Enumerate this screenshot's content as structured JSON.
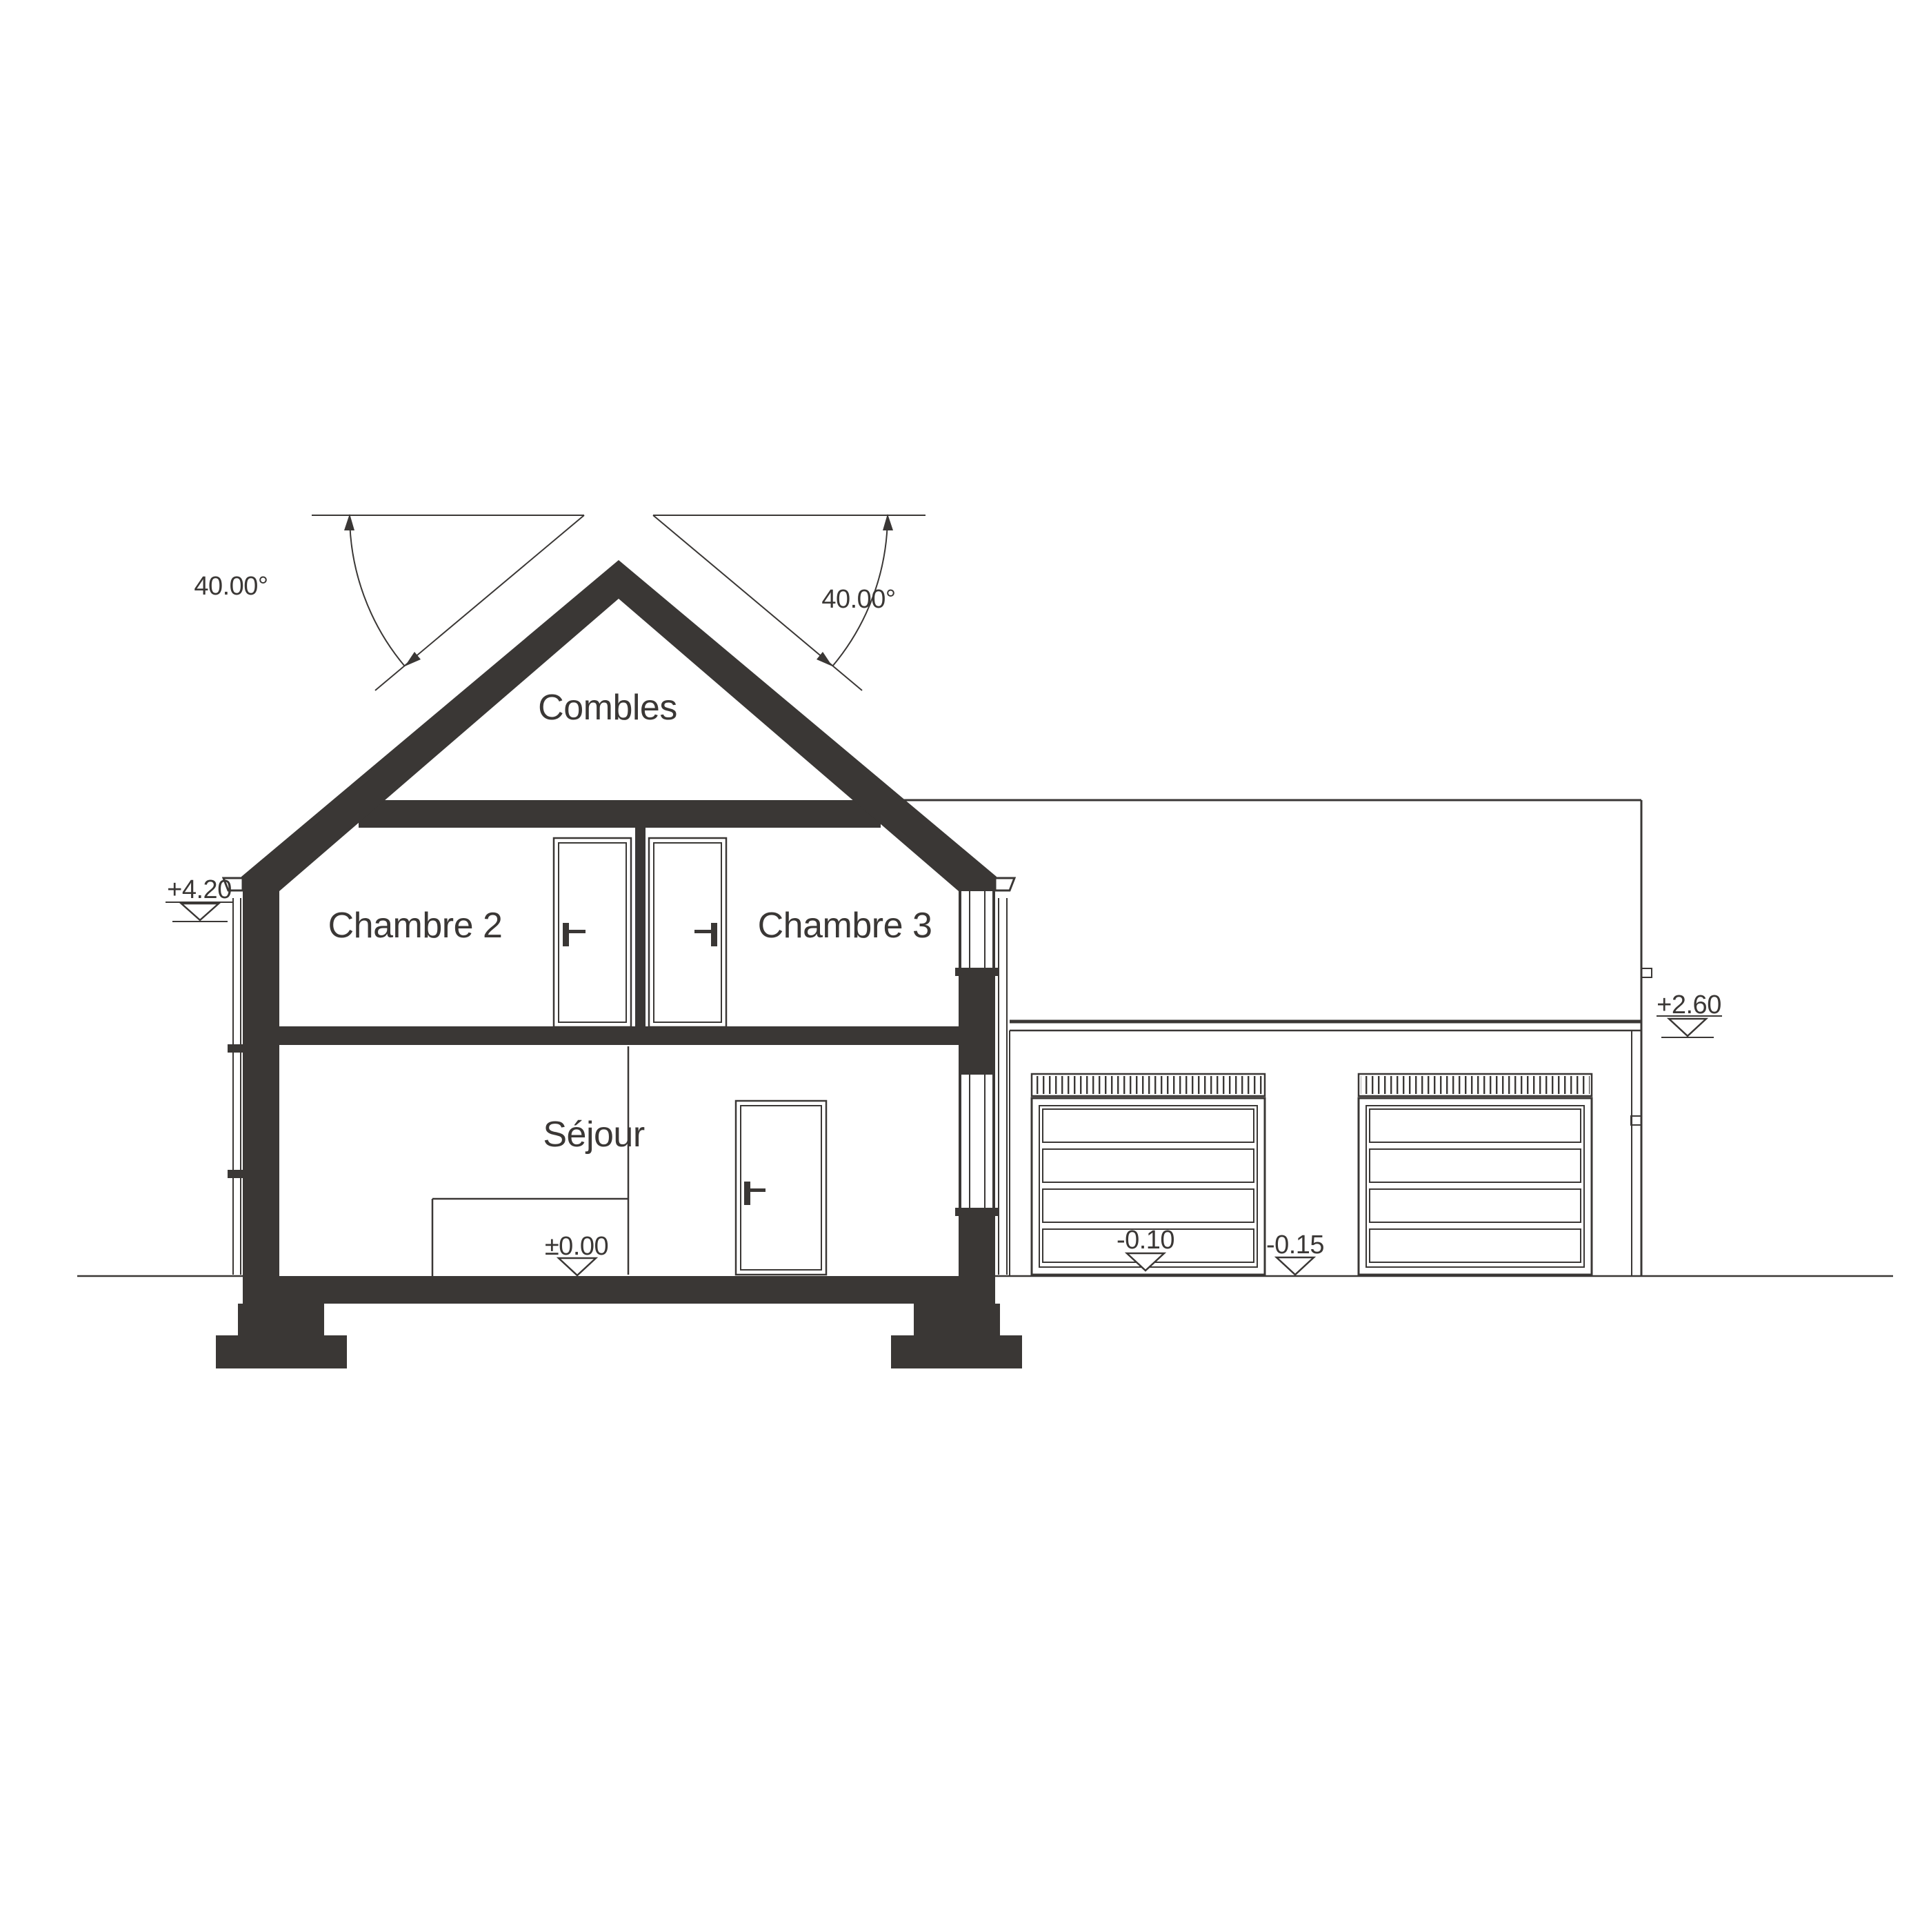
{
  "page": {
    "background": "#ffffff",
    "ink": "#3a3735",
    "drawing_type": "house cross-section with attached garage elevation"
  },
  "section": {
    "rooms": {
      "attic": "Combles",
      "bedroom2": "Chambre 2",
      "bedroom3": "Chambre 3",
      "living": "Séjour"
    },
    "roof_angles": {
      "left": "40.00°",
      "right": "40.00°",
      "pitch_degrees": 40
    },
    "elevation_markers": {
      "eaves_left": "+4.20",
      "ground_floor": "±0.00",
      "garage_door_threshold": "-0.10",
      "garage_apron": "-0.15",
      "garage_eaves": "+2.60"
    }
  }
}
